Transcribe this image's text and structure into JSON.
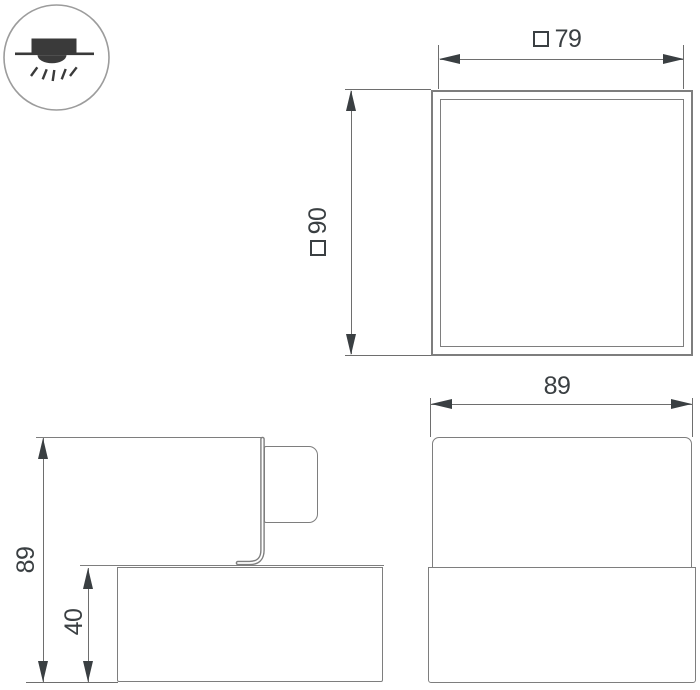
{
  "icon": {
    "name": "recessed-downlight-icon",
    "description_parts": [
      "housing-box",
      "ceiling-line",
      "light-dome",
      "light-rays"
    ]
  },
  "colors": {
    "background": "#ffffff",
    "shape_outline": "#7e7e7e",
    "dimension_line": "#6e6e6e",
    "text_and_arrows": "#3a3f42",
    "icon_fill": "#3a3a3a",
    "icon_circle_stroke": "#9c9c9c"
  },
  "dimensions": {
    "front_width": {
      "symbol": "□",
      "value": "79"
    },
    "front_height": {
      "symbol": "□",
      "value": "90"
    },
    "side_width": {
      "value": "89"
    },
    "section_total_height": {
      "value": "89"
    },
    "section_body_height": {
      "value": "40"
    }
  }
}
